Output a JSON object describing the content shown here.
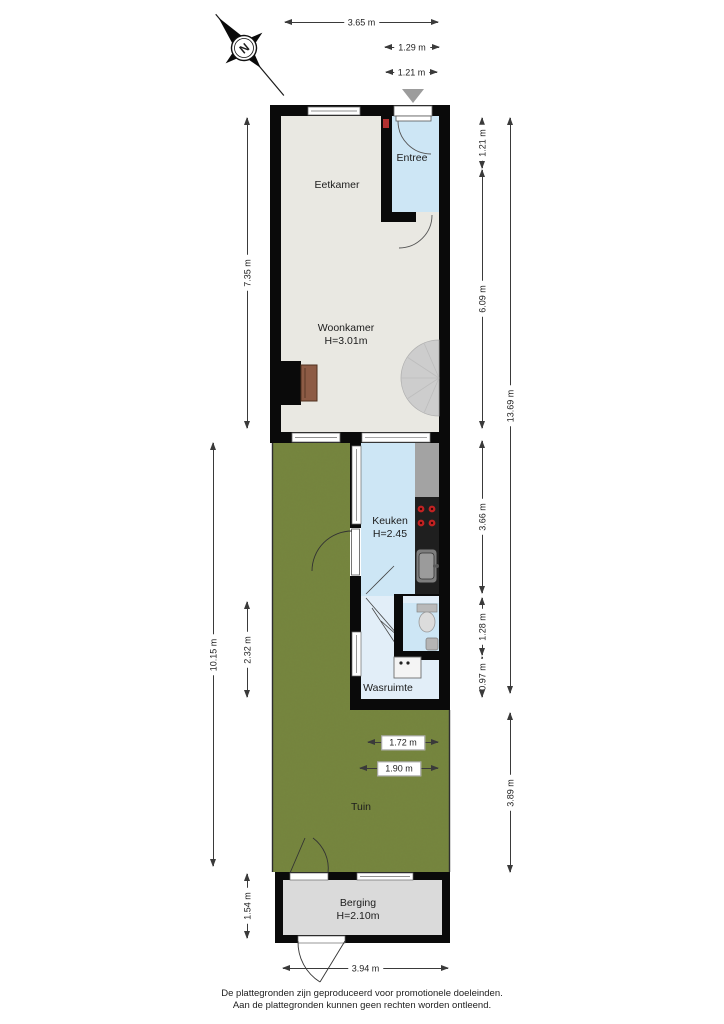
{
  "compass": {
    "letter": "N"
  },
  "rooms": {
    "eetkamer": "Eetkamer",
    "woonkamer": "Woonkamer",
    "woonkamer_height": "H=3.01m",
    "entree": "Entree",
    "keuken": "Keuken",
    "keuken_height": "H=2.45",
    "wasruimte": "Wasruimte",
    "tuin": "Tuin",
    "berging": "Berging",
    "berging_height": "H=2.10m"
  },
  "dimensions": {
    "top_width": "3.65 m",
    "entree_width": "1.29 m",
    "door_width": "1.21 m",
    "right_entree": "1.21 m",
    "right_living": "6.09 m",
    "right_kitchen": "3.66 m",
    "right_wc": "1.28 m",
    "right_wash": "0.97 m",
    "right_total": "13.69 m",
    "right_garden": "3.89 m",
    "left_living": "7.35 m",
    "left_garden_total": "10.15 m",
    "left_wash": "2.32 m",
    "left_berging": "1.54 m",
    "garden_inner_1": "1.72 m",
    "garden_inner_2": "1.90 m",
    "berging_width": "3.94 m"
  },
  "colors": {
    "wall": "#0a0a0a",
    "floor": "#e9e8e2",
    "wet_room_blue": "#cde6f5",
    "wasruimte_blue": "#e2eef8",
    "garden_green": "#75843e",
    "berging_floor": "#dadada",
    "counter_gray": "#a3a3a3",
    "stove_black": "#1f1f1f",
    "burner_red": "#c22222",
    "stairs_gray": "#cdcdcd",
    "entrance_marker_gray": "#9c9c9c"
  },
  "footer": {
    "line1": "De plattegronden zijn geproduceerd voor promotionele doeleinden.",
    "line2": "Aan de plattegronden kunnen geen rechten worden ontleend."
  }
}
